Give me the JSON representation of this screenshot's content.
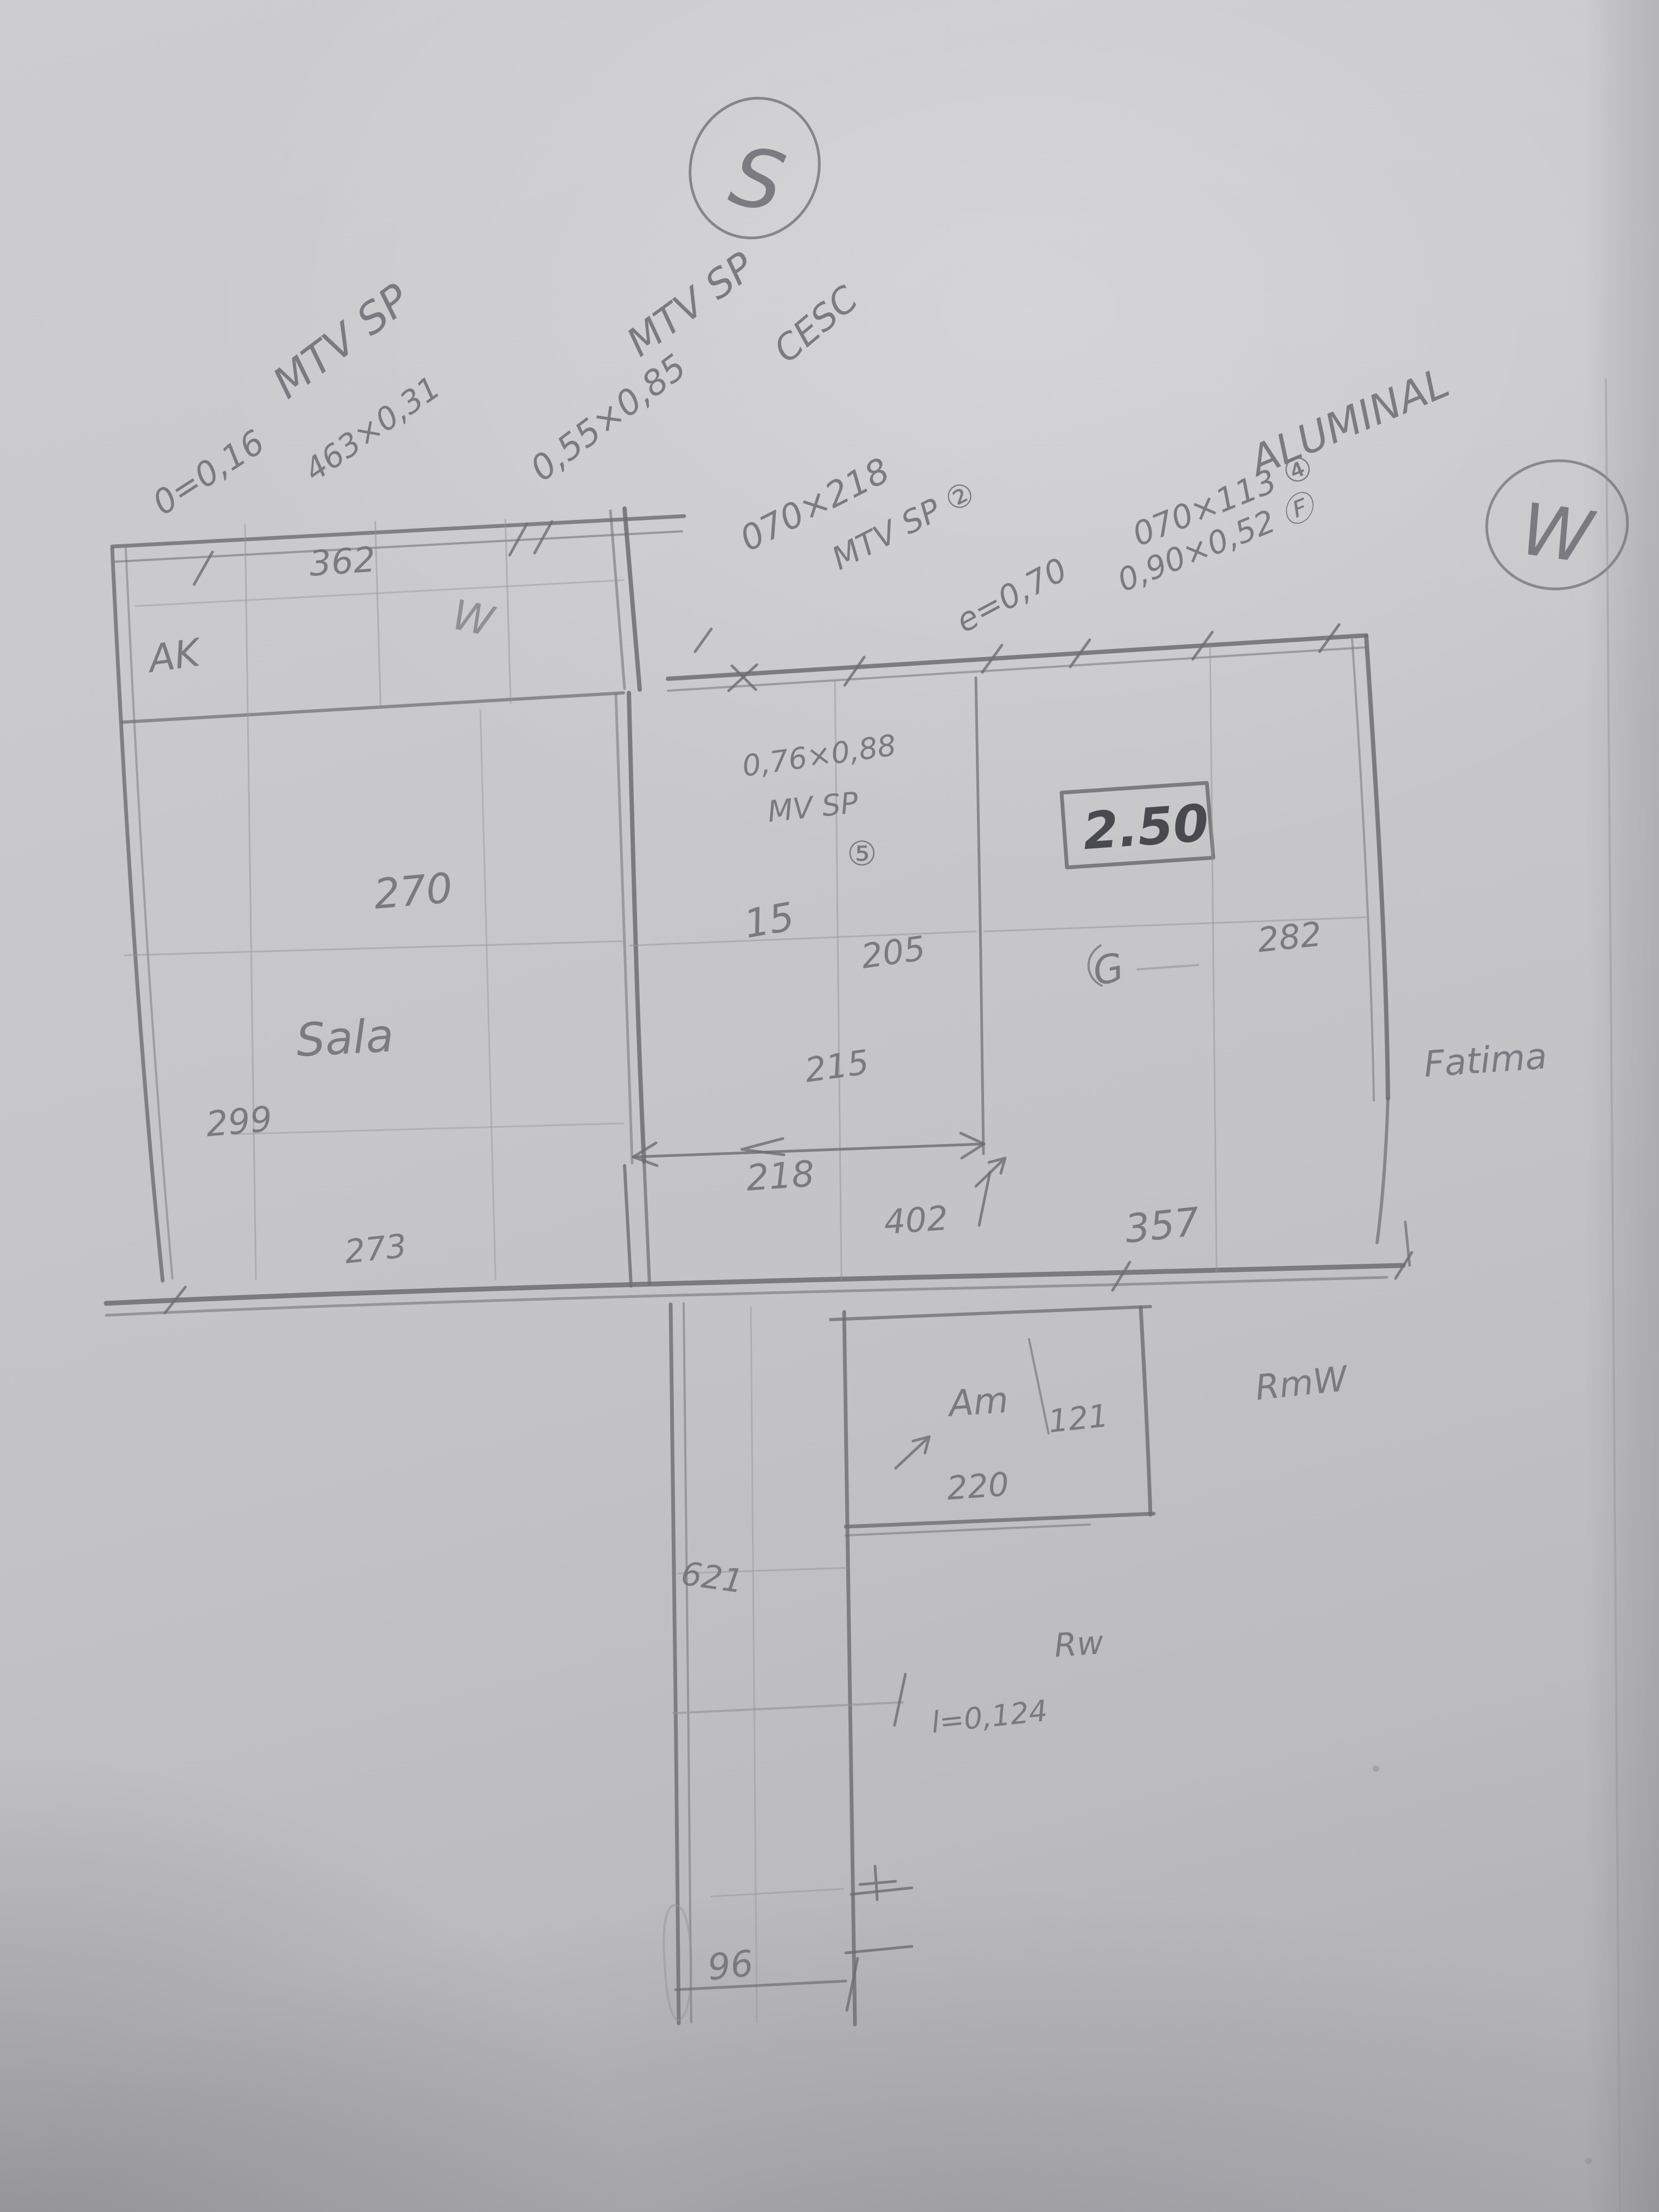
{
  "sketch": {
    "type": "hand-drawn pencil floor plan sketch on paper",
    "marks": {
      "south": "S",
      "west": "W"
    },
    "notes": {
      "mtv1_title": "MTV SP",
      "mtv1_line1": "0=0,16",
      "mtv1_line2": "463×0,31",
      "mtv2_title": "MTV SP",
      "mtv2_code": "CESC",
      "mtv2_size": "0,55×0,85",
      "mtv3_size": "070×218",
      "mtv3_title": "MTV SP ②",
      "mtv3_e": "e=0,70",
      "alu_title": "ALUMINAL",
      "alu_size1": "070×113 ④",
      "alu_size2": "0,90×0,52 Ⓕ",
      "mid_size": "0,76×0,88",
      "mid_title": "MV SP",
      "mid_mark": "⑤",
      "boxed_height": "2.50",
      "l_note": "l=0,124"
    },
    "rooms": {
      "sala": "Sala",
      "am": "Am",
      "rmw": "RmW",
      "rw": "Rw",
      "fatima": "Fatima",
      "ak": "AK",
      "w_inner": "W",
      "g": "G"
    },
    "dims": {
      "d362": "362",
      "d270": "270",
      "d299": "299",
      "d273": "273",
      "d15": "15",
      "d205": "205",
      "d215": "215",
      "d218": "218",
      "d402": "402",
      "d282": "282",
      "d357": "357",
      "d121": "121",
      "d220": "220",
      "d621": "621",
      "d96": "96"
    }
  },
  "colors": {
    "paper": "#c6c6c9",
    "pencil": "#6d6d72",
    "pencil_dark": "#3f3f46",
    "pencil_light": "#94949a"
  }
}
